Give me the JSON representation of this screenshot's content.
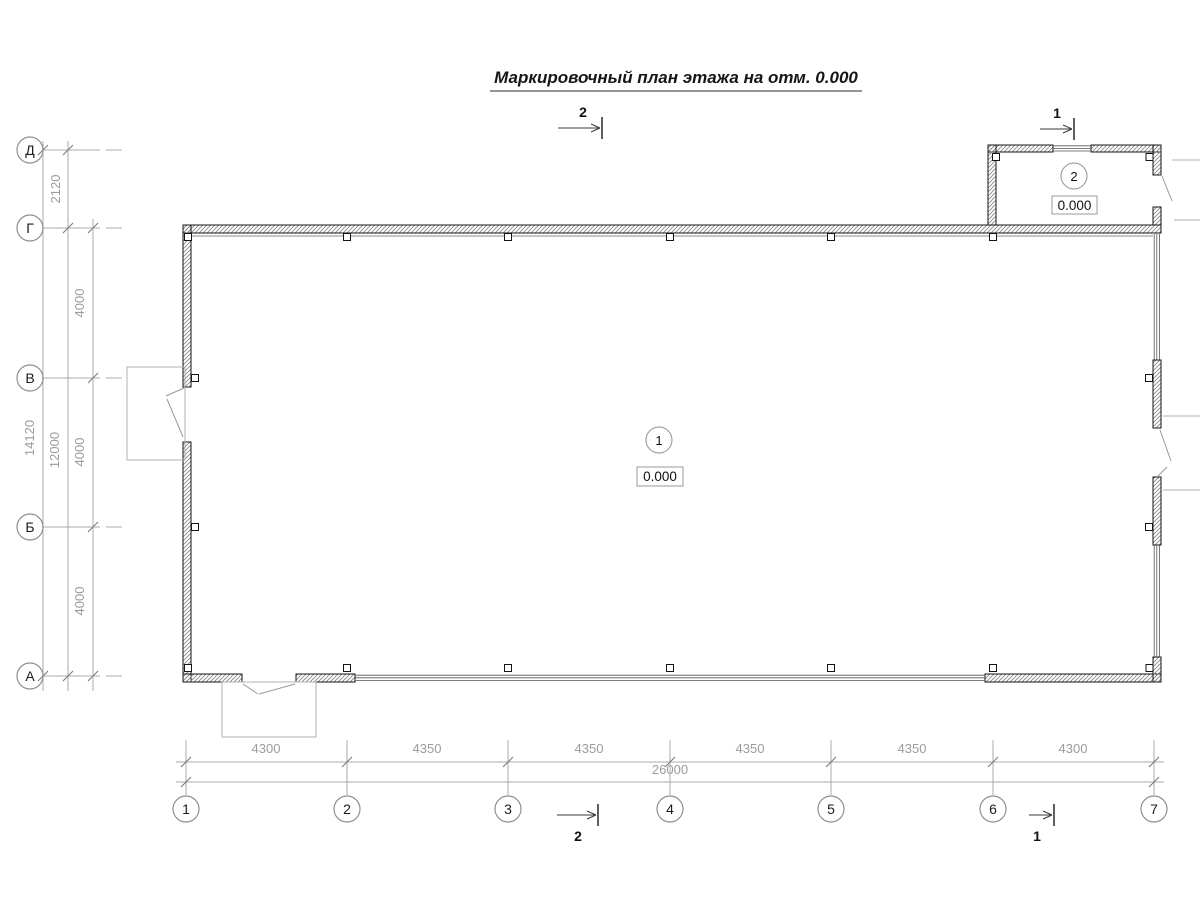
{
  "title": "Маркировочный план этажа на отм. 0.000",
  "grid": {
    "row_labels": [
      "Д",
      "Г",
      "В",
      "Б",
      "А"
    ],
    "col_labels": [
      "1",
      "2",
      "3",
      "4",
      "5",
      "6",
      "7"
    ]
  },
  "dims_left": {
    "overall": "14120",
    "sub_overall": "12000",
    "annex_bay": "2120",
    "bays": [
      "4000",
      "4000",
      "4000"
    ]
  },
  "dims_bottom": {
    "overall": "26000",
    "bays": [
      "4300",
      "4350",
      "4350",
      "4350",
      "4350",
      "4300"
    ]
  },
  "rooms": [
    {
      "number": "1",
      "elevation": "0.000"
    },
    {
      "number": "2",
      "elevation": "0.000"
    }
  ],
  "section_marks": {
    "top": "2",
    "top_right": "1",
    "bottom": "2",
    "bottom_right": "1"
  },
  "colors": {
    "wall_line": "#141414",
    "dim_line": "#ababab",
    "dim_text": "#9c9c9c",
    "hatch": "#8a8a8a"
  }
}
